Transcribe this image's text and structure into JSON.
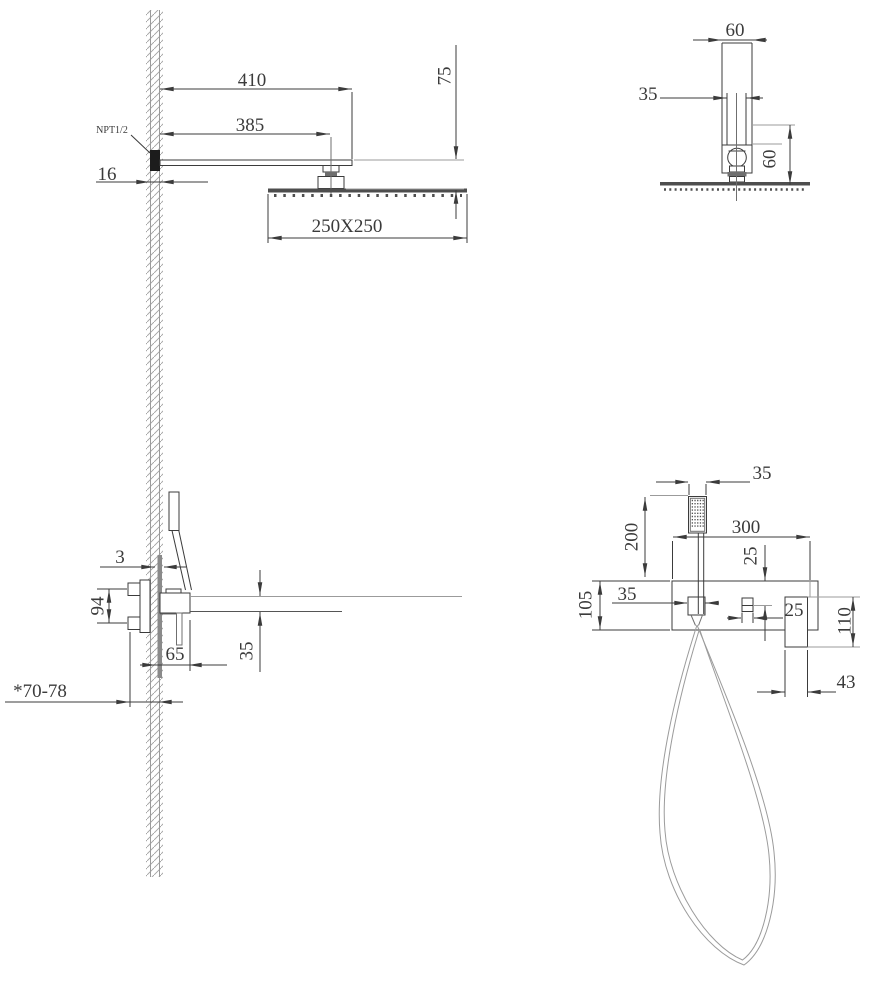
{
  "drawing_colors": {
    "line": "#3b3b3b",
    "light_line": "#9b9b9b",
    "solid_fill": "#4e4e4e"
  },
  "views": {
    "head_side": {
      "arm_length": "410",
      "arm_to_joint": "385",
      "drop_height": "75",
      "wall_thickness": "16",
      "thread_label": "NPT1/2",
      "head_size": "250X250"
    },
    "head_front": {
      "flange_width": "60",
      "arm_width": "35",
      "flange_height": "60"
    },
    "valve_side": {
      "wall_gap": "3",
      "port_spacing": "94",
      "body_depth": "65",
      "spout_height": "35",
      "embed_depth": "*70-78"
    },
    "mixer_front": {
      "hand_shower_width": "35",
      "hand_shower_length": "200",
      "plate_width": "300",
      "handle_offset": "25",
      "holder_width": "35",
      "plate_height": "105",
      "handle_width": "25",
      "spout_drop": "110",
      "spout_width": "43"
    }
  }
}
